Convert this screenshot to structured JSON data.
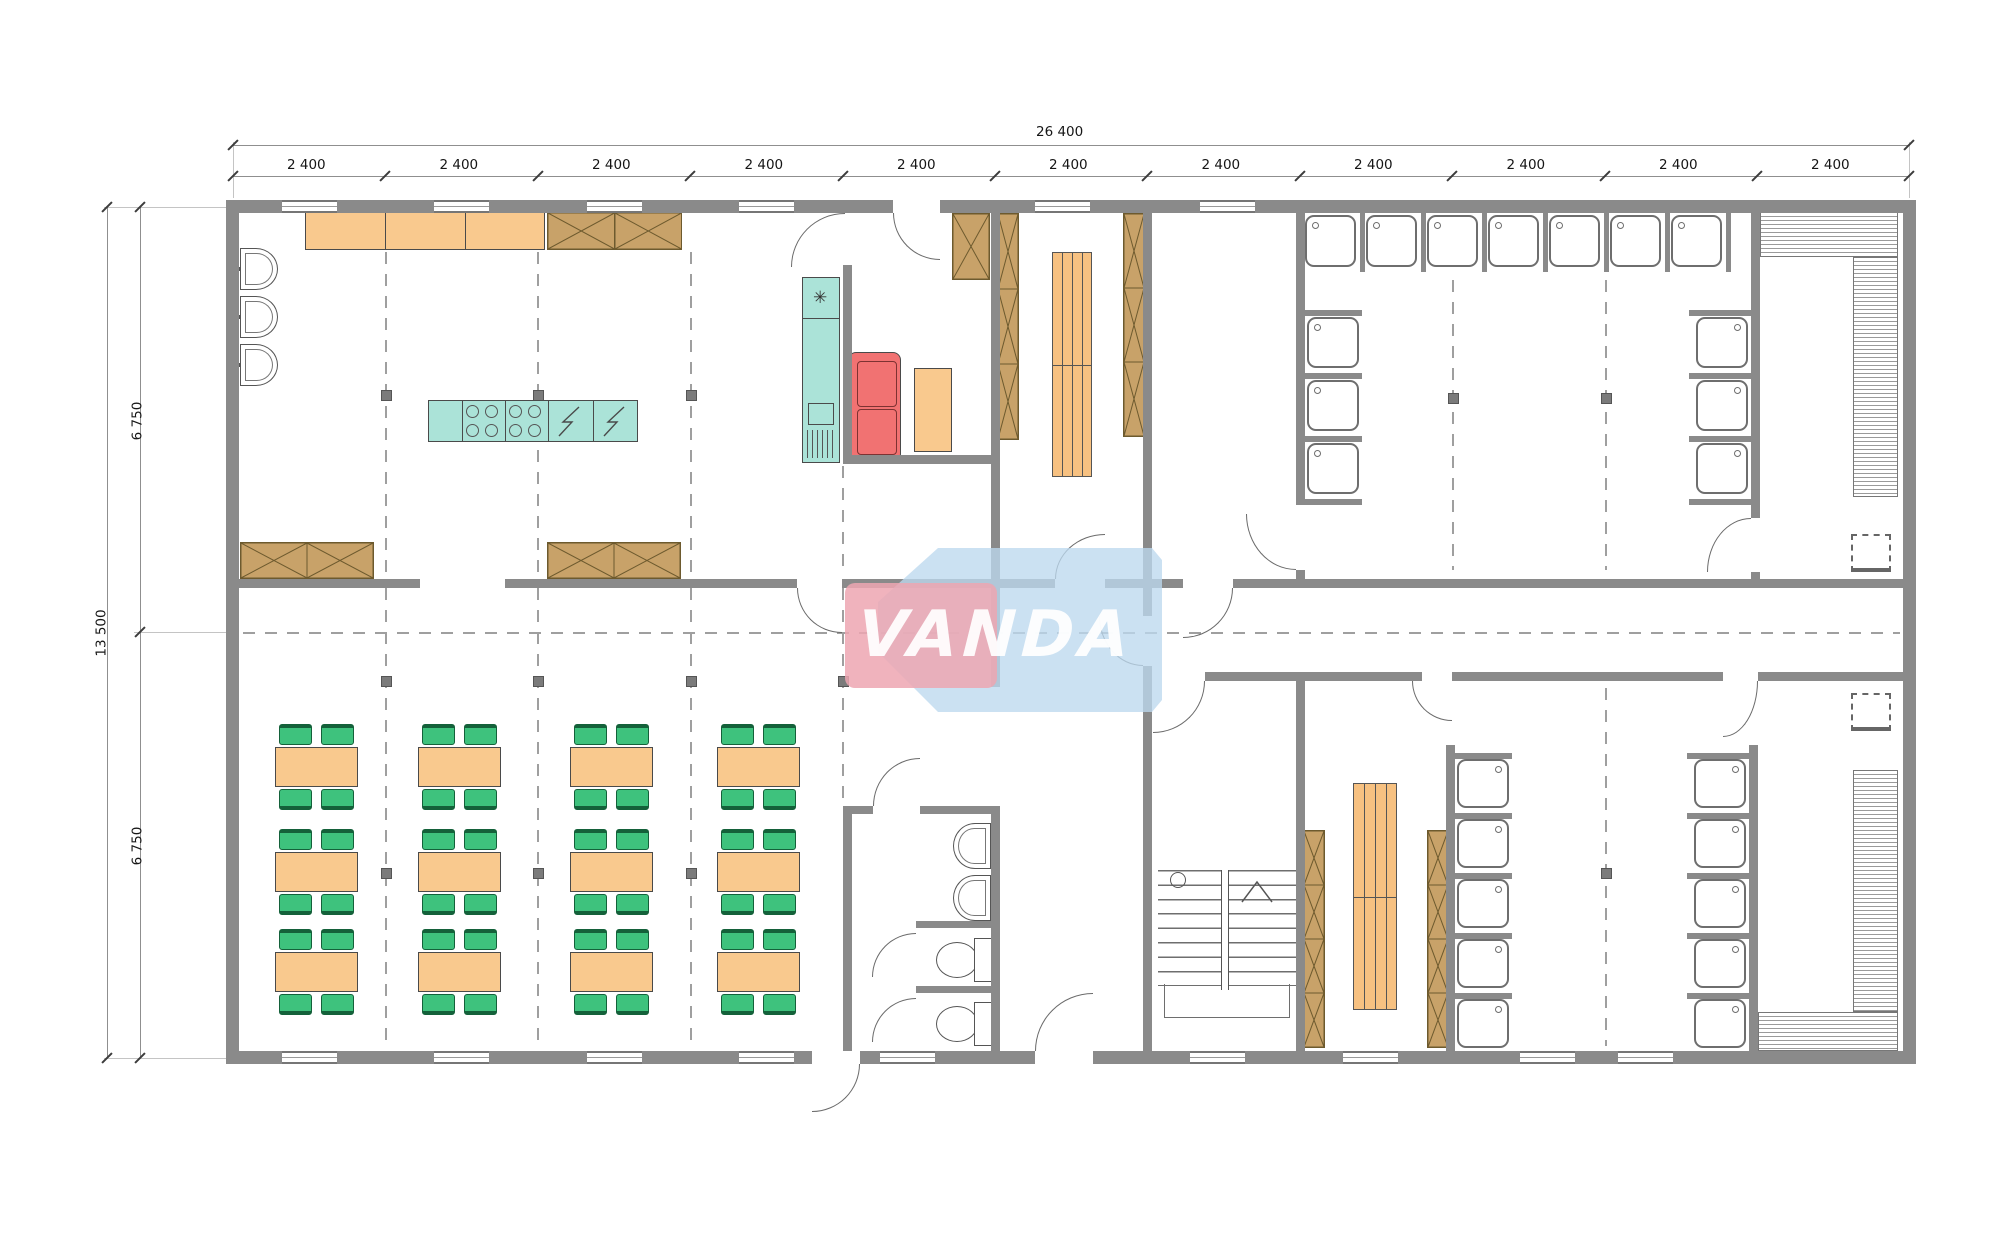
{
  "dims": {
    "total_width": "26 400",
    "bay": "2 400",
    "total_height": "13 500",
    "half_height": "6 750"
  },
  "watermark": {
    "text": "VANDA"
  },
  "symbols": {
    "freezer": "✳"
  },
  "colors": {
    "wall": "#8a8a8a",
    "counter_orange": "#f9c98e",
    "cabinet_brown": "#c8a269",
    "island_teal": "#abe3d8",
    "sofa_red": "#f17272",
    "chair_green": "#3ec27d",
    "watermark_pink": "#eda6b2",
    "watermark_blue": "#bcd9ee"
  }
}
